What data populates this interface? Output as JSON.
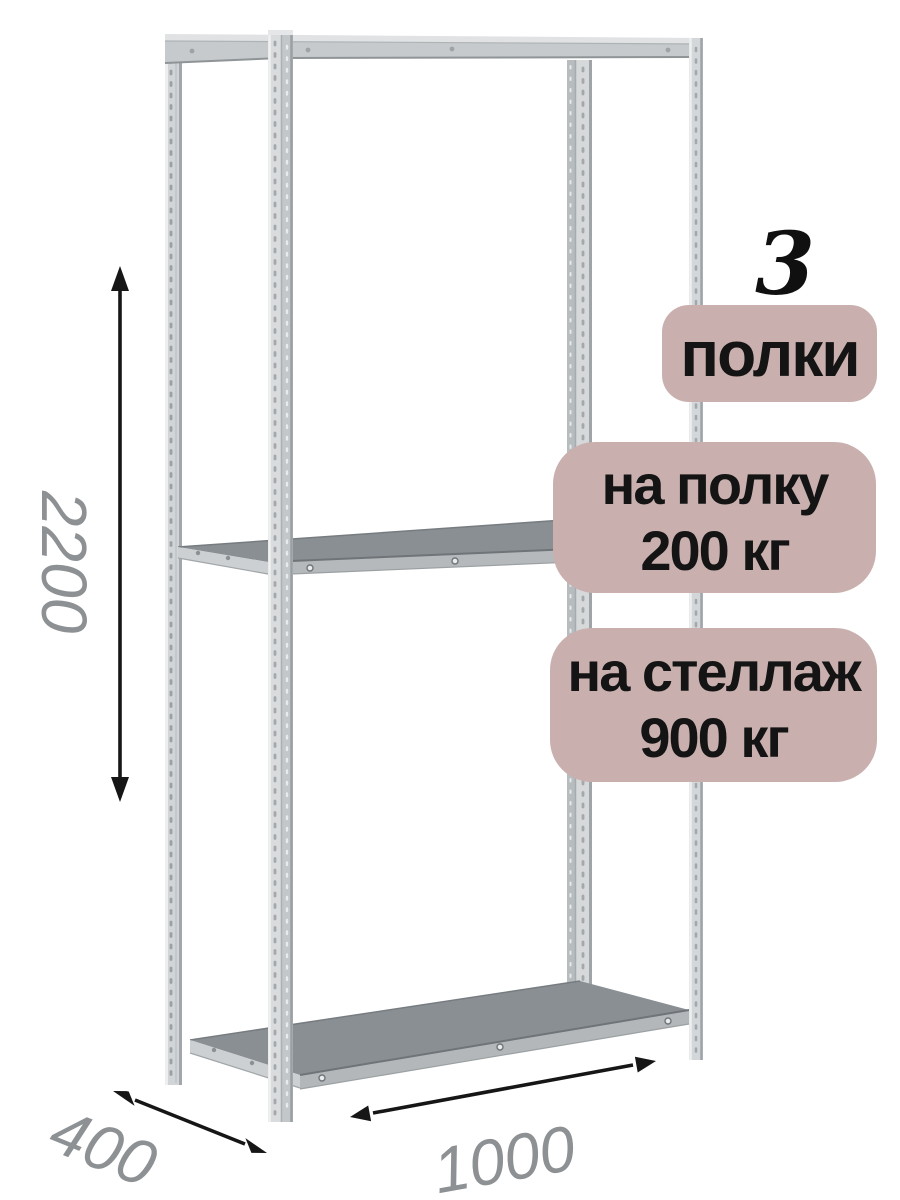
{
  "annotations": {
    "shelf_count": {
      "value": "3",
      "label": "полки"
    },
    "capacity_badges": [
      {
        "line1": "на полку",
        "line2": "200 кг"
      },
      {
        "line1": "на стеллаж",
        "line2": "900 кг"
      }
    ],
    "dimensions": {
      "height_mm": "2200",
      "depth_mm": "400",
      "width_mm": "1000"
    }
  },
  "illustration": {
    "subject": "metal-shelving-rack",
    "shelves_drawn": 3,
    "posts_drawn": 4
  },
  "colors": {
    "badge_bg": "#c9b0ae",
    "badge_text": "#141414",
    "dimension_text": "#8d9193",
    "arrow": "#161616",
    "metal_light": "#d7dadc",
    "metal_mid": "#c4c8cb",
    "metal_dark": "#8a8f94",
    "background": "#ffffff"
  }
}
